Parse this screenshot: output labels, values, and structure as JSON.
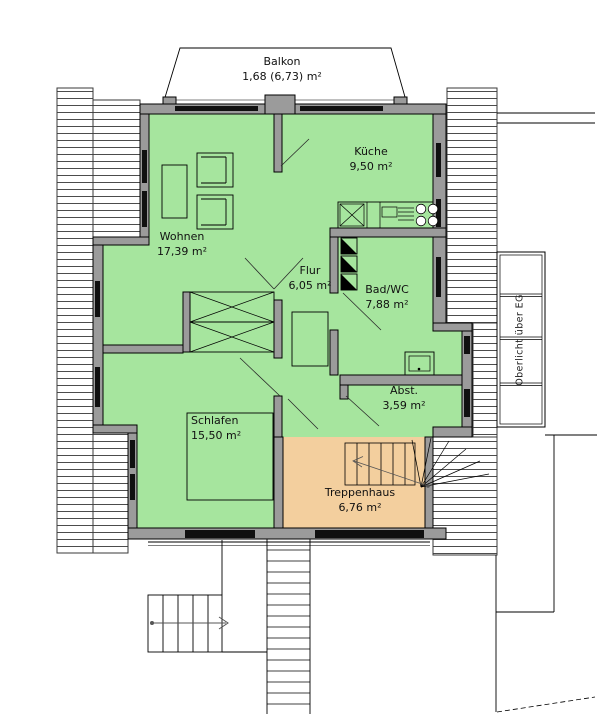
{
  "plan": {
    "rooms": [
      {
        "name": "Balkon",
        "area": "1,68 (6,73) m²"
      },
      {
        "name": "Küche",
        "area": "9,50 m²"
      },
      {
        "name": "Wohnen",
        "area": "17,39 m²"
      },
      {
        "name": "Flur",
        "area": "6,05 m²"
      },
      {
        "name": "Bad/WC",
        "area": "7,88 m²"
      },
      {
        "name": "Abst.",
        "area": "3,59 m²"
      },
      {
        "name": "Schlafen",
        "area": "15,50 m²"
      },
      {
        "name": "Treppenhaus",
        "area": "6,76 m²"
      }
    ],
    "annotations": {
      "skylight_label": "Oberlicht über EG"
    },
    "colors": {
      "room_green": "#a6e59e",
      "stair_orange": "#f3cf9e",
      "wall_gray": "#9b9b9b"
    }
  }
}
